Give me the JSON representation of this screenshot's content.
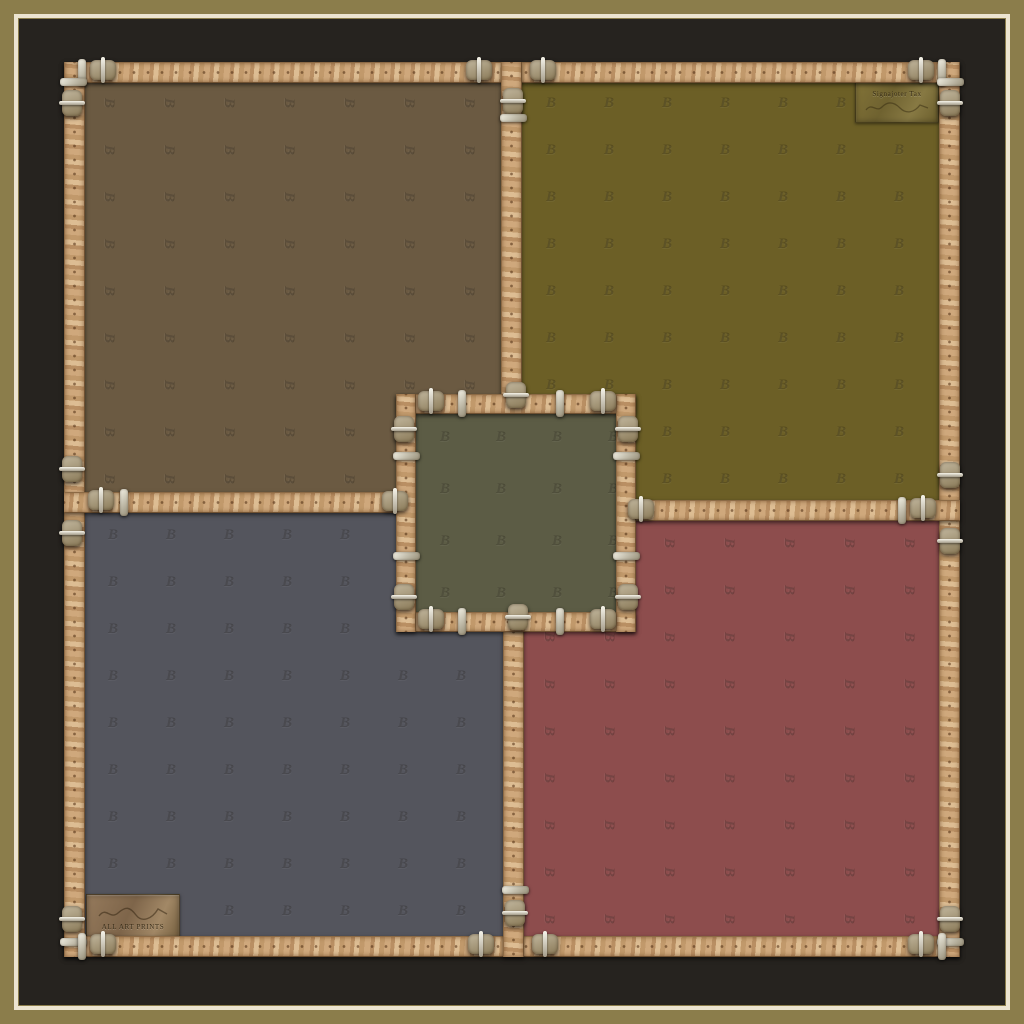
{
  "artwork": {
    "title": "Patchwork scarf with leather belt straps and buckles",
    "monogram_glyph": "B",
    "colors": {
      "outer_frame": "#8b7d4b",
      "inner_line": "#ece4d0",
      "mat": "#26231f",
      "belt": "#c7a176",
      "buckle_metal": "#eceadf",
      "quadrant_top_left": "#6b5a42",
      "quadrant_top_right": "#6c5f26",
      "quadrant_bottom_left": "#54555d",
      "quadrant_bottom_right": "#8d4d4d",
      "center_square": "#5c5c45"
    },
    "patches": {
      "top_right": {
        "line1": "Signajoter Tax"
      },
      "bottom_left": {
        "line2": "ALL ART PRINTS"
      }
    }
  }
}
